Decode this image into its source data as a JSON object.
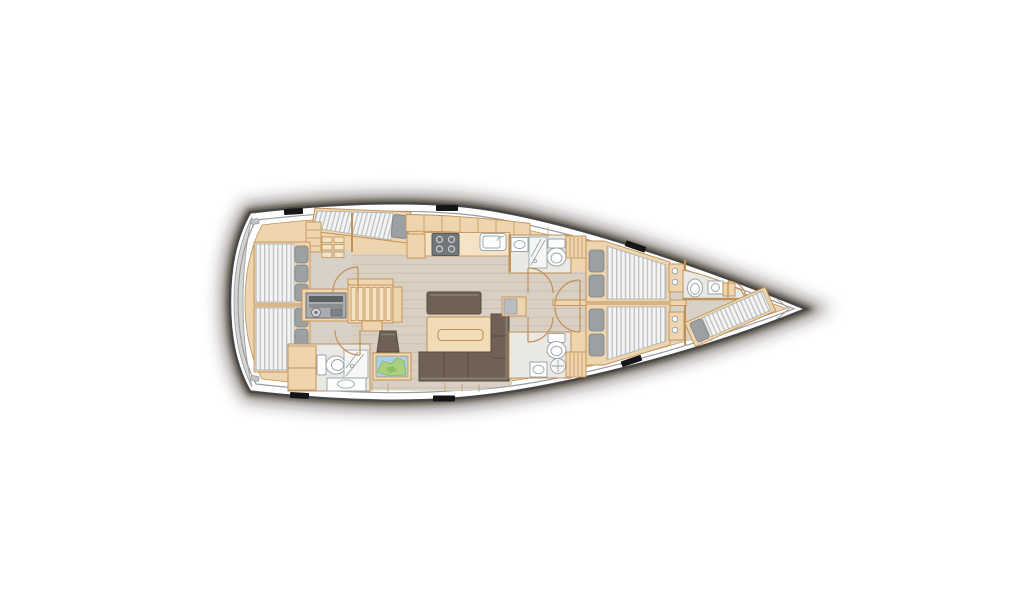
{
  "meta": {
    "title": "Sailing yacht interior deck plan",
    "orientation": "bow-right",
    "visible_text": []
  },
  "palette": {
    "background": "#ffffff",
    "hull_outline": "#474747",
    "inner_line": "#9b9b9b",
    "shadow": "#33241a",
    "wood": "#efd5ad",
    "wood_light": "#f5e3c5",
    "wood_line": "#bf9159",
    "floor_plank": "#d9cfc2",
    "floor_plank_line": "#cbc0b1",
    "cabin_floor": "#d7d1c8",
    "bath_floor": "#eae8e2",
    "fixture_white": "#fdfdfc",
    "fixture_line": "#9aa5ad",
    "mattress": "#f4f4f2",
    "mattress_stripe": "#bcc0c2",
    "pillow": "#9ba0a2",
    "upholstery": "#6f6155",
    "upholstery_line": "#594b3f",
    "upholstery_hi": "#8c7f70",
    "table_wood": "#f2dcb8",
    "hatch": "#151515",
    "transom": "#d3d5d5",
    "appliance": "#70767a",
    "map_sea": "#a9cfe0",
    "map_land": "#abcf7e"
  },
  "vessel": {
    "type": "monohull sailing yacht floor plan, top view",
    "deck_hatches": 6,
    "rooms": [
      {
        "id": "transom",
        "name": "Stern swim platform",
        "features": [
          "gray transom step",
          "mooring fittings"
        ]
      },
      {
        "id": "aft-cabin-port",
        "name": "Aft cabin port",
        "features": [
          "athwartships double berth with 3 pillows",
          "angled single berth with pillow",
          "locker grid 2x3",
          "wardrobe",
          "door"
        ]
      },
      {
        "id": "aft-cabin-starboard",
        "name": "Aft cabin starboard",
        "features": [
          "athwartships double berth with 3 pillows",
          "door"
        ]
      },
      {
        "id": "engine-compartment",
        "name": "Engine compartment",
        "features": [
          "engine unit"
        ]
      },
      {
        "id": "companionway",
        "name": "Companionway",
        "features": [
          "six steps",
          "lower step",
          "side cabinet"
        ]
      },
      {
        "id": "galley",
        "name": "Galley",
        "features": [
          "upper cabinets",
          "counter",
          "four-burner stove",
          "sink with faucet",
          "refrigerator"
        ]
      },
      {
        "id": "aft-head",
        "name": "Aft head (starboard)",
        "features": [
          "toilet",
          "shower",
          "vanity basin",
          "cabinets"
        ]
      },
      {
        "id": "saloon",
        "name": "Saloon",
        "features": [
          "dining table",
          "bench seat",
          "L-shaped sofa",
          "stool",
          "sideboard"
        ]
      },
      {
        "id": "nav-station",
        "name": "Chart table",
        "features": [
          "sea chart"
        ]
      },
      {
        "id": "head-forward-port",
        "name": "Forward head port",
        "features": [
          "toilet",
          "shower",
          "washbasin",
          "door"
        ]
      },
      {
        "id": "head-forward-starboard",
        "name": "Forward head starboard",
        "features": [
          "toilet",
          "shower",
          "washbasin",
          "door"
        ]
      },
      {
        "id": "cabin-forward-port",
        "name": "Forward cabin port",
        "features": [
          "double berth",
          "two pillows",
          "entry wardrobe",
          "shelf unit",
          "door"
        ]
      },
      {
        "id": "cabin-forward-starboard",
        "name": "Forward cabin starboard",
        "features": [
          "double berth",
          "two pillows",
          "entry wardrobe",
          "shelf unit",
          "door"
        ]
      },
      {
        "id": "bow-head",
        "name": "Bow head",
        "features": [
          "toilet",
          "washbasin",
          "shelf",
          "door"
        ]
      },
      {
        "id": "bow-cabin",
        "name": "Bow crew cabin",
        "features": [
          "angled single berth",
          "pillow"
        ]
      }
    ]
  }
}
